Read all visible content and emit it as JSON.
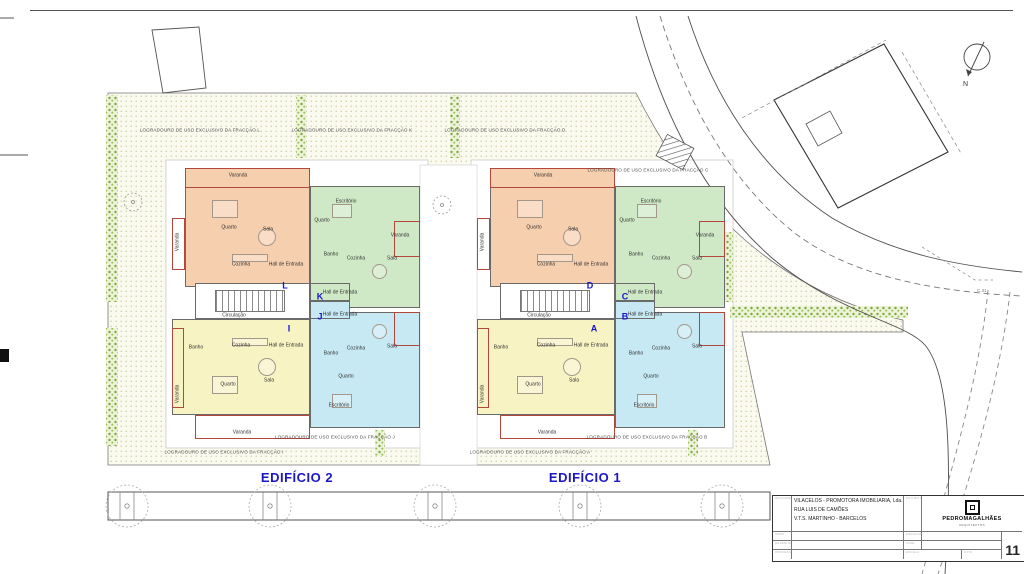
{
  "plan": {
    "north_label": "N",
    "road_marker": "C.31",
    "circulation_text": "Circulação",
    "edificio_labels": [
      {
        "text": "EDIFÍCIO 2",
        "x": 297,
        "y": 470
      },
      {
        "text": "EDIFÍCIO 1",
        "x": 585,
        "y": 470
      }
    ],
    "logradouro_labels": [
      {
        "text": "LOGRADOURO DE USO EXCLUSIVO DA FRACÇÃO L",
        "x": 200,
        "y": 130
      },
      {
        "text": "LOGRADOURO DE USO EXCLUSIVO DA FRACÇÃO K",
        "x": 352,
        "y": 130
      },
      {
        "text": "LOGRADOURO DE USO EXCLUSIVO DA FRACÇÃO D",
        "x": 505,
        "y": 130
      },
      {
        "text": "LOGRADOURO DE USO EXCLUSIVO DA FRACÇÃO C",
        "x": 648,
        "y": 170
      },
      {
        "text": "LOGRADOURO DE USO EXCLUSIVO DA FRACÇÃO I",
        "x": 224,
        "y": 452
      },
      {
        "text": "LOGRADOURO DE USO EXCLUSIVO DA FRACÇÃO J",
        "x": 335,
        "y": 437
      },
      {
        "text": "LOGRADOURO DE USO EXCLUSIVO DA FRACÇÃO A",
        "x": 530,
        "y": 452
      },
      {
        "text": "LOGRADOURO DE USO EXCLUSIVO DA FRACÇÃO B",
        "x": 647,
        "y": 437
      }
    ],
    "buildings": [
      {
        "id": "2",
        "x": 172,
        "y": 166,
        "letters": [
          {
            "t": "L",
            "x": 113,
            "y": 120
          },
          {
            "t": "K",
            "x": 148,
            "y": 131
          },
          {
            "t": "J",
            "x": 148,
            "y": 151
          },
          {
            "t": "I",
            "x": 117,
            "y": 163
          }
        ]
      },
      {
        "id": "1",
        "x": 477,
        "y": 166,
        "letters": [
          {
            "t": "D",
            "x": 113,
            "y": 120
          },
          {
            "t": "C",
            "x": 148,
            "y": 131
          },
          {
            "t": "B",
            "x": 148,
            "y": 151
          },
          {
            "t": "A",
            "x": 117,
            "y": 163
          }
        ]
      }
    ],
    "unit_template": {
      "units": [
        {
          "id": "orange",
          "x": 13,
          "y": 2,
          "w": 125,
          "h": 119,
          "fill": "#f6cfae"
        },
        {
          "id": "green",
          "x": 138,
          "y": 20,
          "w": 110,
          "h": 122,
          "fill": "#cfe9c6"
        },
        {
          "id": "yellow",
          "x": 0,
          "y": 153,
          "w": 138,
          "h": 96,
          "fill": "#f8f3c3"
        },
        {
          "id": "cyan",
          "x": 138,
          "y": 146,
          "w": 110,
          "h": 116,
          "fill": "#c6e9f3"
        },
        {
          "id": "hall-green",
          "x": 138,
          "y": 117,
          "w": 40,
          "h": 18,
          "fill": "#cfe9c6"
        },
        {
          "id": "hall-cyan",
          "x": 138,
          "y": 135,
          "w": 40,
          "h": 18,
          "fill": "#c6e9f3"
        },
        {
          "id": "circulation",
          "x": 23,
          "y": 117,
          "w": 115,
          "h": 36,
          "fill": "#ffffff"
        }
      ],
      "balconies": [
        {
          "x": 13,
          "y": 2,
          "w": 125,
          "h": 20
        },
        {
          "x": 0,
          "y": 52,
          "w": 13,
          "h": 52
        },
        {
          "x": 222,
          "y": 55,
          "w": 26,
          "h": 36
        },
        {
          "x": 23,
          "y": 249,
          "w": 115,
          "h": 24
        },
        {
          "x": 0,
          "y": 162,
          "w": 12,
          "h": 80
        },
        {
          "x": 222,
          "y": 146,
          "w": 26,
          "h": 34
        }
      ],
      "stairs": {
        "x": 43,
        "y": 124,
        "w": 70,
        "h": 22
      },
      "circulation_label": {
        "x": 62,
        "y": 150
      },
      "rooms": [
        {
          "label": "Varanda",
          "x": 66,
          "y": 10
        },
        {
          "label": "Quarto",
          "x": 57,
          "y": 62
        },
        {
          "label": "Sala",
          "x": 96,
          "y": 64
        },
        {
          "label": "Cozinha",
          "x": 69,
          "y": 99
        },
        {
          "label": "Hall de Entrada",
          "x": 114,
          "y": 99
        },
        {
          "label": "Varanda",
          "x": 6,
          "y": 76,
          "vert": true
        },
        {
          "label": "Quarto",
          "x": 150,
          "y": 55
        },
        {
          "label": "Escritório",
          "x": 174,
          "y": 36
        },
        {
          "label": "Banho",
          "x": 159,
          "y": 89
        },
        {
          "label": "Cozinha",
          "x": 184,
          "y": 93
        },
        {
          "label": "Sala",
          "x": 220,
          "y": 93
        },
        {
          "label": "Varanda",
          "x": 228,
          "y": 70
        },
        {
          "label": "Hall de Entrada",
          "x": 168,
          "y": 127
        },
        {
          "label": "Hall de Entrada",
          "x": 168,
          "y": 149
        },
        {
          "label": "Banho",
          "x": 24,
          "y": 182
        },
        {
          "label": "Cozinha",
          "x": 69,
          "y": 180
        },
        {
          "label": "Hall de Entrada",
          "x": 114,
          "y": 180
        },
        {
          "label": "Quarto",
          "x": 56,
          "y": 219
        },
        {
          "label": "Sala",
          "x": 97,
          "y": 215
        },
        {
          "label": "Varanda",
          "x": 6,
          "y": 228,
          "vert": true
        },
        {
          "label": "Varanda",
          "x": 70,
          "y": 267
        },
        {
          "label": "Banho",
          "x": 159,
          "y": 188
        },
        {
          "label": "Cozinha",
          "x": 184,
          "y": 183
        },
        {
          "label": "Sala",
          "x": 220,
          "y": 181
        },
        {
          "label": "Quarto",
          "x": 174,
          "y": 211
        },
        {
          "label": "Escritório",
          "x": 167,
          "y": 240
        }
      ],
      "furniture": [
        {
          "t": "r",
          "x": 40,
          "y": 34,
          "w": 26,
          "h": 18
        },
        {
          "t": "c",
          "x": 86,
          "y": 62,
          "d": 18
        },
        {
          "t": "r",
          "x": 60,
          "y": 88,
          "w": 36,
          "h": 8
        },
        {
          "t": "r",
          "x": 160,
          "y": 38,
          "w": 20,
          "h": 14
        },
        {
          "t": "c",
          "x": 200,
          "y": 98,
          "d": 15
        },
        {
          "t": "r",
          "x": 40,
          "y": 210,
          "w": 26,
          "h": 18
        },
        {
          "t": "c",
          "x": 86,
          "y": 192,
          "d": 18
        },
        {
          "t": "r",
          "x": 60,
          "y": 172,
          "w": 36,
          "h": 8
        },
        {
          "t": "r",
          "x": 160,
          "y": 228,
          "w": 20,
          "h": 14
        },
        {
          "t": "c",
          "x": 200,
          "y": 158,
          "d": 15
        }
      ]
    }
  },
  "titleblock": {
    "client": "VILACELOS - PROMOTORA IMOBILIARIA, Lda.",
    "address1": "RUA LUIS DE CAMÕES",
    "address2": "V.T.S. MARTINHO - BARCELOS",
    "project": "ALTERAÇÃO DE EDIFÍCIO HABITAÇÃO MULTIFAMILIAR",
    "drawing": "PLANTAS DO PISO 1",
    "process": "PROCESSO nº 90007",
    "firm": "PEDROMAGALHÃES",
    "firm_sub": "ARQUITECTOS",
    "specialty": "ARQUITECTURA",
    "phase": "LICENCIAMENTO",
    "scale": "1:100",
    "date": "JUL 2024",
    "sheet": "11",
    "micro": {
      "client": "REQUERENTE",
      "work": "OBRA",
      "drawing": "DESENHO",
      "process": "PROCESSO",
      "designer": "PROJECTISTA",
      "specialty": "ESPECIALIDADE",
      "phase": "FASE",
      "scale": "ESCALA",
      "date": "DATA"
    }
  }
}
